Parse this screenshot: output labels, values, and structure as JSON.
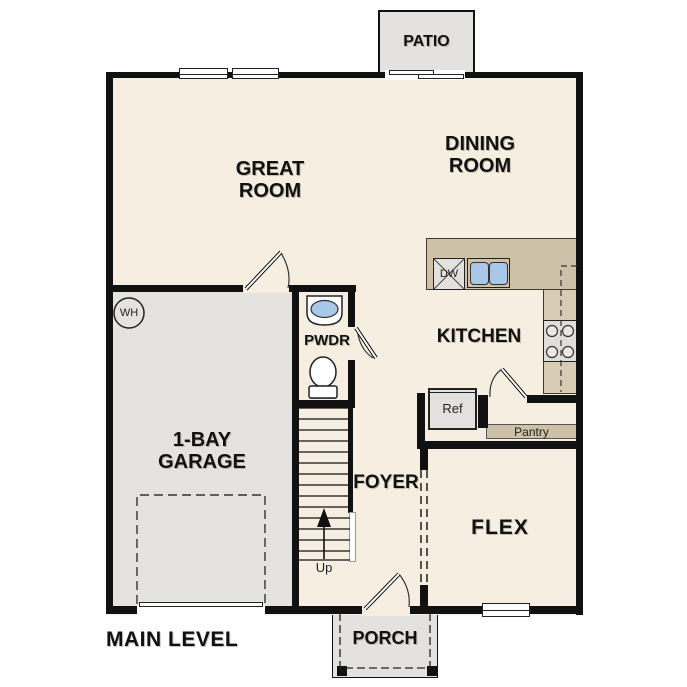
{
  "title": {
    "main_level": "MAIN LEVEL"
  },
  "rooms": {
    "great_room": {
      "line1": "GREAT",
      "line2": "ROOM"
    },
    "dining_room": {
      "line1": "DINING",
      "line2": "ROOM"
    },
    "kitchen": {
      "label": "KITCHEN"
    },
    "powder": {
      "label": "PWDR"
    },
    "foyer": {
      "label": "FOYER"
    },
    "flex": {
      "label": "FLEX"
    },
    "garage": {
      "line1": "1-BAY",
      "line2": "GARAGE"
    }
  },
  "outdoor": {
    "patio": "PATIO",
    "porch": "PORCH"
  },
  "fixtures": {
    "water_heater": "WH",
    "dishwasher": "DW",
    "refrigerator": "Ref",
    "pantry": "Pantry",
    "stairs_direction": "Up"
  },
  "colors": {
    "floor": "#f6efe1",
    "garage_floor": "#e4e3e0",
    "outdoor_concrete": "#e3e2e0",
    "counter_tan": "#cdc1a8",
    "counter_tan_light": "#d8ccb4",
    "sink_blue": "#a9c7e9",
    "wall_black": "#111111"
  }
}
